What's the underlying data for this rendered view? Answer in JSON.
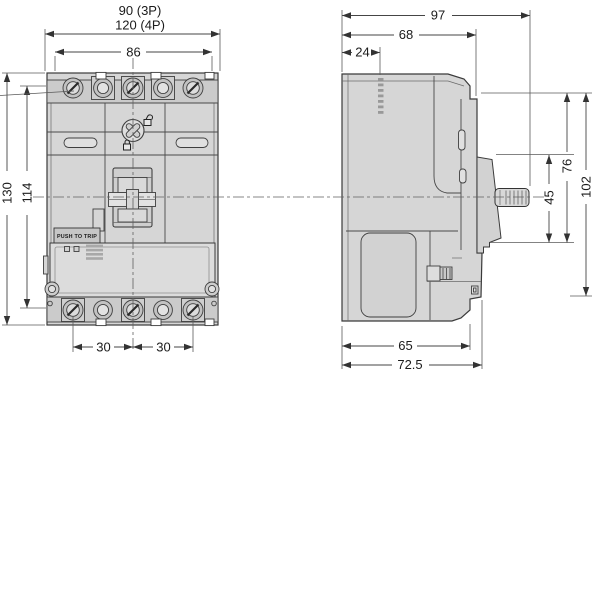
{
  "front": {
    "dims": {
      "width_3p": "90 (3P)",
      "width_4p": "120 (4P)",
      "mount_width": "86",
      "height": "130",
      "mount_height": "114",
      "pitch_a": "30",
      "pitch_b": "30"
    },
    "labels": {
      "push_to_trip": "PUSH TO TRIP"
    }
  },
  "side": {
    "dims": {
      "depth_overall": "97",
      "depth_body": "68",
      "depth_back": "24",
      "height_front": "76",
      "height_handle": "45",
      "height_overall": "102",
      "depth_base": "65",
      "depth_base_overall": "72.5"
    }
  },
  "icons": {
    "padlock_open": "padlock-open-icon",
    "padlock_locked": "padlock-locked-icon"
  },
  "colors": {
    "background": "#ffffff",
    "body_fill": "#d6d6d6",
    "body_fill_dark": "#c9c9c9",
    "body_fill_light": "#e0e0e0",
    "line": "#3a3a3a",
    "dimension": "#454545",
    "text": "#1b1b1b"
  }
}
